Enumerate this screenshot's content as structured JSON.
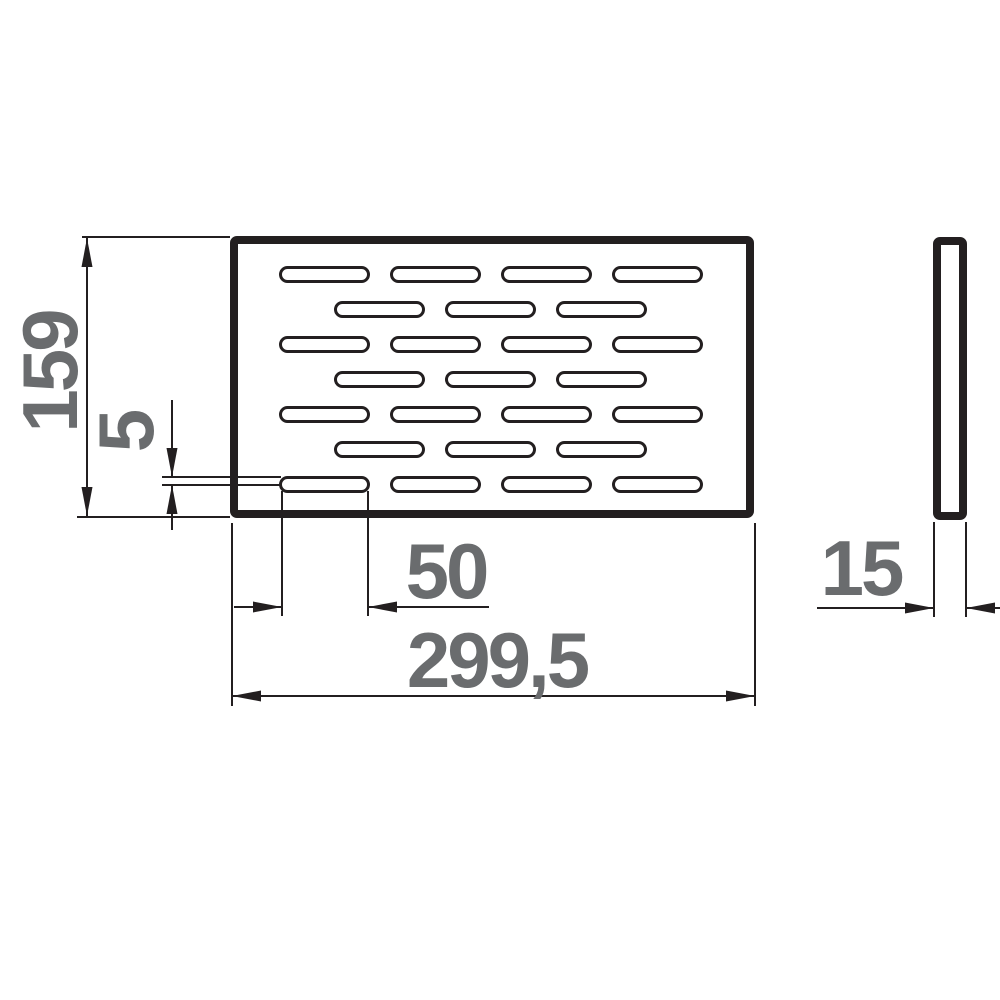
{
  "drawing": {
    "title": "perforated-plate-dimension-drawing",
    "colors": {
      "line": "#231f20",
      "text": "#6a6c6e",
      "background": "#ffffff"
    },
    "views": {
      "front": {
        "label": "front-view",
        "slot_rows": 7,
        "slots_in_odd_rows": 4,
        "slots_in_even_rows": 3
      },
      "side": {
        "label": "side-view"
      }
    },
    "dimensions": {
      "height": {
        "value": "159"
      },
      "slot_height": {
        "value": "5"
      },
      "slot_length": {
        "value": "50"
      },
      "width": {
        "value": "299,5"
      },
      "thickness": {
        "value": "15"
      }
    }
  },
  "slot_grid": {
    "rows": 7,
    "row_height": 14,
    "row_pitch": 35,
    "first_row_top": 267.5,
    "slot_width": 88,
    "corner_radius": 7,
    "odd_row_starts": [
      280.5,
      391.5,
      502.5,
      613.5
    ],
    "even_row_starts": [
      335.5,
      446.5,
      557.5
    ]
  }
}
